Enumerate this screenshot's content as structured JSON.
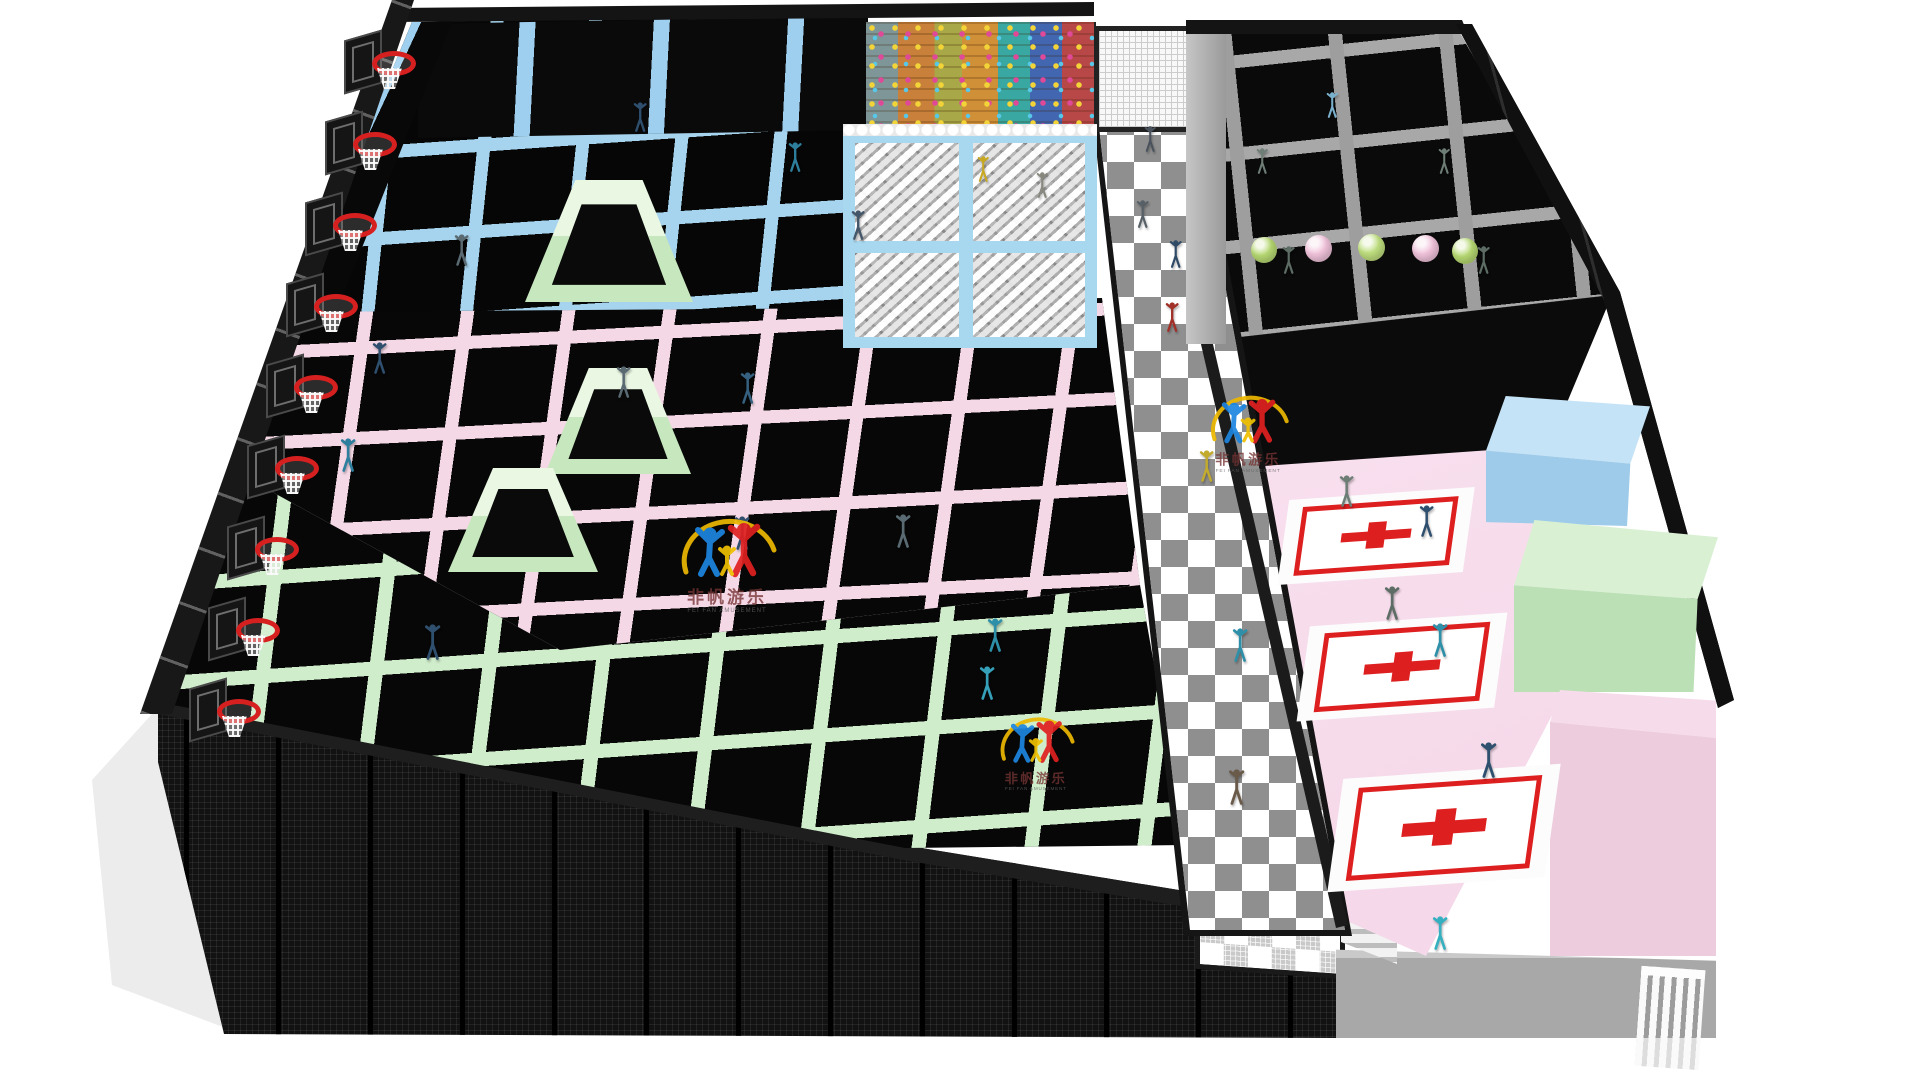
{
  "scene": {
    "description": "3D rendering of an indoor trampoline park viewed from above on a white background",
    "watermark": {
      "brand_cn": "非帆游乐",
      "brand_en": "FEI FAN AMUSEMENT",
      "colors": {
        "arc": "#edb800",
        "figure_left": "#1d86e0",
        "figure_right": "#e02020",
        "figure_center": "#f0c000",
        "text_cn": "#763434",
        "text_en": "#606060"
      },
      "instances": [
        {
          "x": 672,
          "y": 512,
          "scale": 1.0
        },
        {
          "x": 993,
          "y": 712,
          "scale": 0.78
        },
        {
          "x": 1203,
          "y": 390,
          "scale": 0.82
        }
      ]
    },
    "palette": {
      "background": "#ffffff",
      "frame_black": "#161616",
      "trampoline_bed_black": "#070707",
      "pad_blue": "#a6d4ee",
      "pad_pink": "#f5d8e6",
      "pad_green": "#cfeccb",
      "pad_gray": "#a2a2a2",
      "foam_pit_blue": "#a8d8f0",
      "checker_gray": "#8f8f8f",
      "court_pink": "#f7dcec",
      "mat_red": "#dd1f1f",
      "hoop_red": "#d62020",
      "wall_gray": "#a8a8a8"
    },
    "zones": [
      {
        "id": "slam-dunk-lanes",
        "color": "#a6d4ee"
      },
      {
        "id": "free-jump-blue",
        "color": "#a6d4ee"
      },
      {
        "id": "free-jump-pink",
        "color": "#f5d8e6"
      },
      {
        "id": "free-jump-green",
        "color": "#cfeccb"
      },
      {
        "id": "pro-jump-gray",
        "color": "#a2a2a2"
      },
      {
        "id": "climbing-wall",
        "color": "multicolor"
      },
      {
        "id": "foam-pit",
        "color": "#a8d8f0"
      },
      {
        "id": "checker-walkway",
        "color": "#8f8f8f"
      },
      {
        "id": "dodgeball-court",
        "color": "#f7dcec"
      }
    ],
    "objects": {
      "basketball_hoops": [
        {
          "x": 380,
          "y": 55
        },
        {
          "x": 361,
          "y": 136
        },
        {
          "x": 341,
          "y": 217
        },
        {
          "x": 322,
          "y": 298
        },
        {
          "x": 302,
          "y": 379
        },
        {
          "x": 283,
          "y": 460
        },
        {
          "x": 263,
          "y": 541
        },
        {
          "x": 244,
          "y": 622
        },
        {
          "x": 225,
          "y": 703
        }
      ],
      "wedges": [
        {
          "x": 525,
          "y": 180,
          "w": 168,
          "h": 122
        },
        {
          "x": 545,
          "y": 368,
          "w": 146,
          "h": 106
        },
        {
          "x": 448,
          "y": 468,
          "w": 150,
          "h": 104
        }
      ],
      "exercise_balls": [
        {
          "x": 1264,
          "y": 250,
          "d": 26,
          "c": "#b6d872"
        },
        {
          "x": 1318,
          "y": 248,
          "d": 27,
          "c": "#f0c2da"
        },
        {
          "x": 1371,
          "y": 247,
          "d": 27,
          "c": "#bede7e"
        },
        {
          "x": 1425,
          "y": 248,
          "d": 27,
          "c": "#f0c2da"
        },
        {
          "x": 1465,
          "y": 251,
          "d": 26,
          "c": "#b6d872"
        }
      ],
      "court_mats": [
        {
          "x": 1283,
          "y": 494,
          "w": 186,
          "h": 84,
          "rot": -4
        },
        {
          "x": 1303,
          "y": 620,
          "w": 198,
          "h": 94,
          "rot": -4
        },
        {
          "x": 1335,
          "y": 772,
          "w": 218,
          "h": 112,
          "rot": -4
        }
      ],
      "people": [
        {
          "x": 640,
          "y": 132,
          "h": 30,
          "c": "#2f4f6e"
        },
        {
          "x": 795,
          "y": 172,
          "h": 30,
          "c": "#2e7f9e"
        },
        {
          "x": 462,
          "y": 266,
          "h": 32,
          "c": "#5a6a72"
        },
        {
          "x": 858,
          "y": 240,
          "h": 30,
          "c": "#44566a"
        },
        {
          "x": 983,
          "y": 182,
          "h": 26,
          "c": "#c8a820"
        },
        {
          "x": 1042,
          "y": 198,
          "h": 26,
          "c": "#88887e"
        },
        {
          "x": 1332,
          "y": 118,
          "h": 26,
          "c": "#7ab0cc"
        },
        {
          "x": 1262,
          "y": 174,
          "h": 26,
          "c": "#6e7e76"
        },
        {
          "x": 1444,
          "y": 174,
          "h": 26,
          "c": "#6e7e76"
        },
        {
          "x": 1289,
          "y": 274,
          "h": 28,
          "c": "#5d6d65"
        },
        {
          "x": 1484,
          "y": 274,
          "h": 28,
          "c": "#5d6d65"
        },
        {
          "x": 1150,
          "y": 152,
          "h": 26,
          "c": "#49525c"
        },
        {
          "x": 1143,
          "y": 228,
          "h": 28,
          "c": "#566066"
        },
        {
          "x": 1176,
          "y": 268,
          "h": 28,
          "c": "#2f4a66"
        },
        {
          "x": 1172,
          "y": 332,
          "h": 30,
          "c": "#a03028"
        },
        {
          "x": 1207,
          "y": 482,
          "h": 32,
          "c": "#c2aa2e"
        },
        {
          "x": 1240,
          "y": 662,
          "h": 34,
          "c": "#2e8fa8"
        },
        {
          "x": 1237,
          "y": 805,
          "h": 36,
          "c": "#6a5a4a"
        },
        {
          "x": 380,
          "y": 374,
          "h": 32,
          "c": "#2f4f6e"
        },
        {
          "x": 348,
          "y": 472,
          "h": 34,
          "c": "#2e7f9e"
        },
        {
          "x": 624,
          "y": 398,
          "h": 32,
          "c": "#5a6a72"
        },
        {
          "x": 748,
          "y": 404,
          "h": 32,
          "c": "#35607f"
        },
        {
          "x": 903,
          "y": 548,
          "h": 34,
          "c": "#5a6a72"
        },
        {
          "x": 742,
          "y": 550,
          "h": 34,
          "c": "#2f4f6e"
        },
        {
          "x": 433,
          "y": 660,
          "h": 36,
          "c": "#2f4f6e"
        },
        {
          "x": 995,
          "y": 652,
          "h": 34,
          "c": "#2e8fa8"
        },
        {
          "x": 987,
          "y": 700,
          "h": 34,
          "c": "#35a0b8"
        },
        {
          "x": 1347,
          "y": 507,
          "h": 32,
          "c": "#6e7e76"
        },
        {
          "x": 1427,
          "y": 537,
          "h": 32,
          "c": "#2f4f6e"
        },
        {
          "x": 1392,
          "y": 620,
          "h": 34,
          "c": "#5d6d65"
        },
        {
          "x": 1440,
          "y": 657,
          "h": 34,
          "c": "#2e8fa8"
        },
        {
          "x": 1489,
          "y": 778,
          "h": 36,
          "c": "#2f4f6e"
        },
        {
          "x": 1440,
          "y": 950,
          "h": 34,
          "c": "#35b0c0"
        }
      ]
    }
  }
}
